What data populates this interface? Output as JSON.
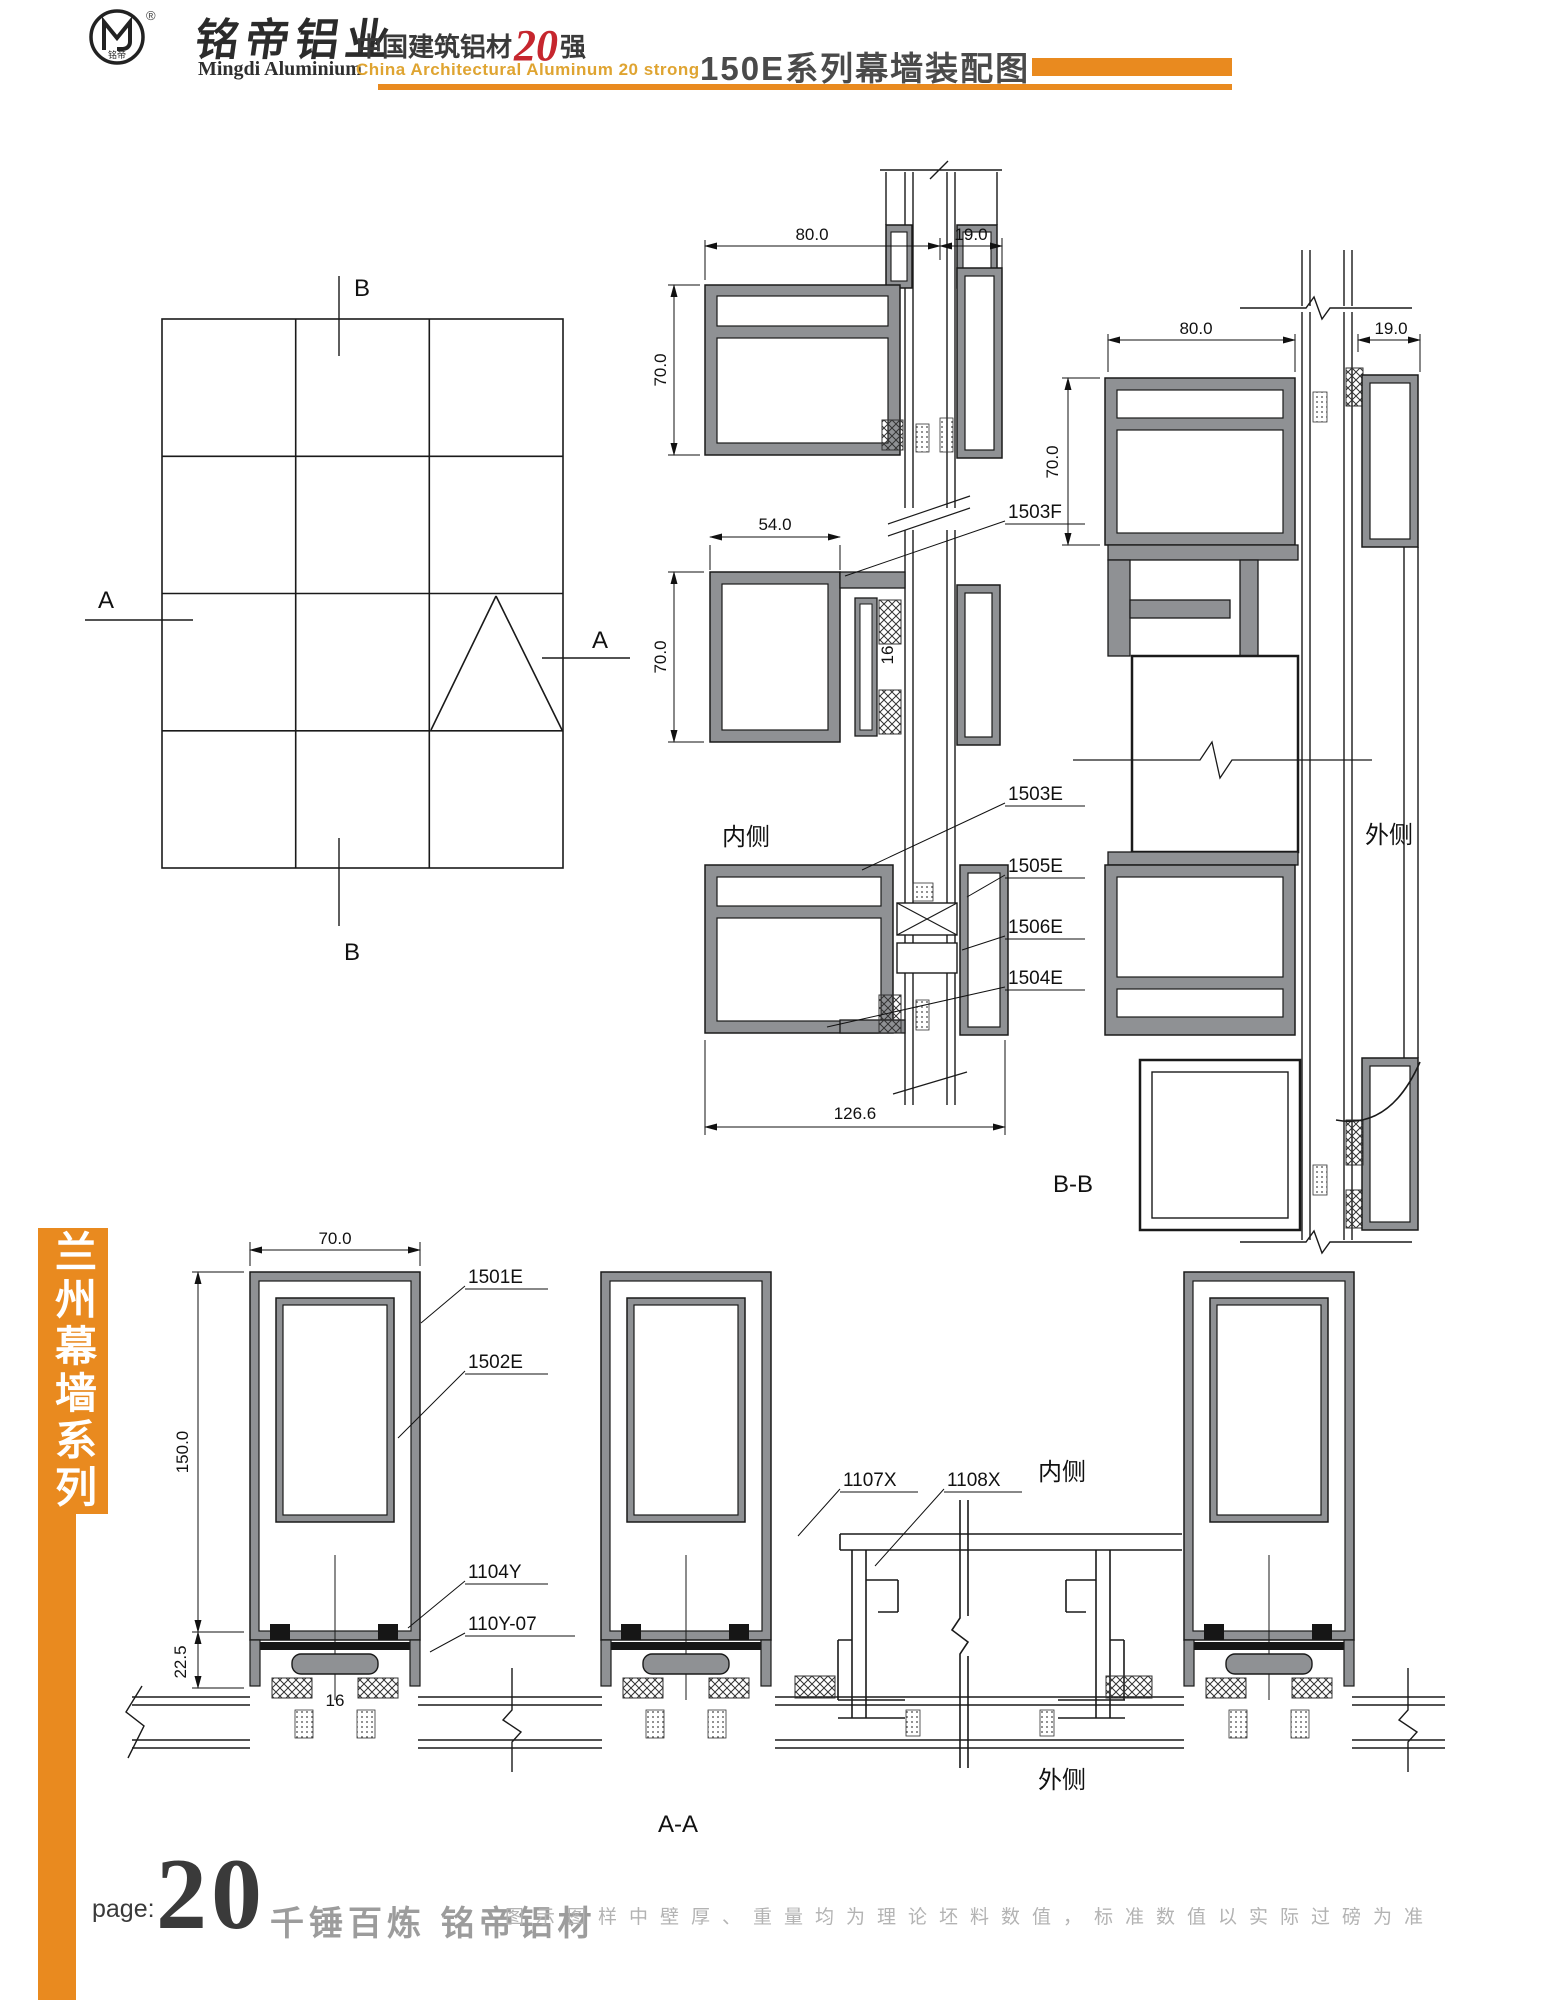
{
  "header": {
    "reg_mark": "®",
    "logo_text": "铭帝",
    "brand_cn": "铭帝铝业",
    "brand_en": "Mingdi Aluminium",
    "slogan_cn_prefix": "中国建筑铝材",
    "slogan_number": "20",
    "slogan_cn_suffix": "强",
    "slogan_en": "China Architectural Aluminum 20 strong",
    "page_title": "150E系列幕墙装配图"
  },
  "side_banner": {
    "series_text": "兰州幕墙系列"
  },
  "footer": {
    "page_label": "page:",
    "page_number": "20",
    "slogan": "千锤百炼  铭帝铝材",
    "note": "图示图样中壁厚、重量均为理论坯料数值，标准数值以实际过磅为准"
  },
  "drawing": {
    "elevation": {
      "marker_a": "A",
      "marker_b": "B"
    },
    "section_labels": {
      "aa": "A-A",
      "bb": "B-B"
    },
    "side_labels": {
      "inner": "内侧",
      "outer": "外侧"
    },
    "dimensions": {
      "d80": "80.0",
      "d19": "19.0",
      "d70": "70.0",
      "d54": "54.0",
      "d16": "16",
      "d126": "126.6",
      "d150": "150.0",
      "d22": "22.5"
    },
    "part_labels": {
      "f1503": "1503F",
      "e1503": "1503E",
      "e1505": "1505E",
      "e1506": "1506E",
      "e1504": "1504E",
      "e1501": "1501E",
      "e1502": "1502E",
      "y1104": "1104Y",
      "y110_07": "110Y-07",
      "x1107": "1107X",
      "x1108": "1108X"
    }
  },
  "colors": {
    "orange": "#e98a1f",
    "gold": "#dfa431",
    "red": "#c6262e",
    "title_gray": "#4a4a4a",
    "line": "#1a1a1a",
    "alu_fill": "#8f9194",
    "footer_gray": "#9c9c9c",
    "note_gray": "#b3b3b3"
  }
}
